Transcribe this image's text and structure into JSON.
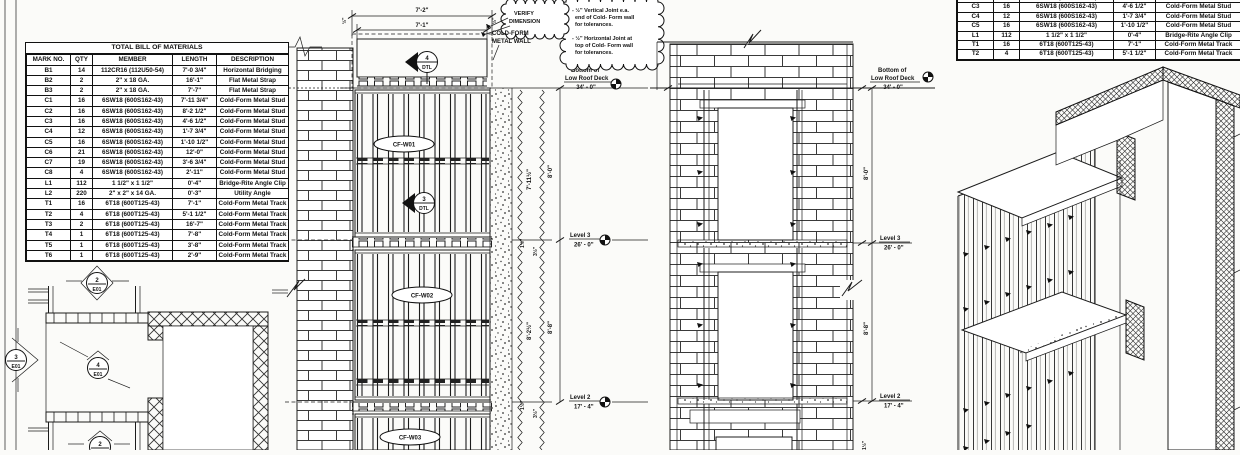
{
  "bom": {
    "title": "TOTAL BILL OF MATERIALS",
    "headers": [
      "MARK NO.",
      "QTY",
      "MEMBER",
      "LENGTH",
      "DESCRIPTION"
    ],
    "rows": [
      [
        "B1",
        "14",
        "112CR16 (112U50-54)",
        "7'-0 3/4\"",
        "Horizontal Bridging"
      ],
      [
        "B2",
        "2",
        "2\" x 18 GA.",
        "16'-1\"",
        "Flat Metal Strap"
      ],
      [
        "B3",
        "2",
        "2\" x 18 GA.",
        "7'-7\"",
        "Flat Metal Strap"
      ],
      [
        "C1",
        "16",
        "6SW18 (600S162-43)",
        "7'-11 3/4\"",
        "Cold-Form Metal Stud"
      ],
      [
        "C2",
        "16",
        "6SW18 (600S162-43)",
        "8'-2 1/2\"",
        "Cold-Form Metal Stud"
      ],
      [
        "C3",
        "16",
        "6SW18 (600S162-43)",
        "4'-6 1/2\"",
        "Cold-Form Metal Stud"
      ],
      [
        "C4",
        "12",
        "6SW18 (600S162-43)",
        "1'-7 3/4\"",
        "Cold-Form Metal Stud"
      ],
      [
        "C5",
        "16",
        "6SW18 (600S162-43)",
        "1'-10 1/2\"",
        "Cold-Form Metal Stud"
      ],
      [
        "C6",
        "21",
        "6SW18 (600S162-43)",
        "12'-0\"",
        "Cold-Form Metal Stud"
      ],
      [
        "C7",
        "19",
        "6SW18 (600S162-43)",
        "3'-6 3/4\"",
        "Cold-Form Metal Stud"
      ],
      [
        "C8",
        "4",
        "6SW18 (600S162-43)",
        "2'-11\"",
        "Cold-Form Metal Stud"
      ],
      [
        "L1",
        "112",
        "1 1/2\" x 1 1/2\"",
        "0'-4\"",
        "Bridge-Rite Angle Clip"
      ],
      [
        "L2",
        "220",
        "2\" x 2\" x 14 GA.",
        "0'-3\"",
        "Utility Angle"
      ],
      [
        "T1",
        "16",
        "6T18 (600T125-43)",
        "7'-1\"",
        "Cold-Form Metal Track"
      ],
      [
        "T2",
        "4",
        "6T18 (600T125-43)",
        "5'-1 1/2\"",
        "Cold-Form Metal Track"
      ],
      [
        "T3",
        "2",
        "6T18 (600T125-43)",
        "16'-7\"",
        "Cold-Form Metal Track"
      ],
      [
        "T4",
        "1",
        "6T18 (600T125-43)",
        "7'-8\"",
        "Cold-Form Metal Track"
      ],
      [
        "T5",
        "1",
        "6T18 (600T125-43)",
        "3'-8\"",
        "Cold-Form Metal Track"
      ],
      [
        "T6",
        "1",
        "6T18 (600T125-43)",
        "2'-9\"",
        "Cold-Form Metal Track"
      ]
    ]
  },
  "bom_right": {
    "rows": [
      [
        "C2",
        "16",
        "6SW18 (600S162-43)",
        "8'-2 1/2\"",
        "Cold-Form Metal Stud"
      ],
      [
        "C3",
        "16",
        "6SW18 (600S162-43)",
        "4'-6 1/2\"",
        "Cold-Form Metal Stud"
      ],
      [
        "C4",
        "12",
        "6SW18 (600S162-43)",
        "1'-7 3/4\"",
        "Cold-Form Metal Stud"
      ],
      [
        "C5",
        "16",
        "6SW18 (600S162-43)",
        "1'-10 1/2\"",
        "Cold-Form Metal Stud"
      ],
      [
        "L1",
        "112",
        "1 1/2\" x 1 1/2\"",
        "0'-4\"",
        "Bridge-Rite Angle Clip"
      ],
      [
        "T1",
        "16",
        "6T18 (600T125-43)",
        "7'-1\"",
        "Cold-Form Metal Track"
      ],
      [
        "T2",
        "4",
        "6T18 (600T125-43)",
        "5'-1 1/2\"",
        "Cold-Form Metal Track"
      ]
    ]
  },
  "cloud": {
    "verify_1": "VERIFY",
    "verify_2": "DIMENSION",
    "note1": [
      "- ½\" Vertical Joint e.a.",
      "end of Cold- Form wall",
      "for tolerances."
    ],
    "note2": [
      "- ½\" Horizontal Joint at",
      "top of Cold- Form wall",
      "for tolerances."
    ]
  },
  "central": {
    "dim_outer": "7'-2\"",
    "dim_inner": "7'-1\"",
    "joint_left": "½\"",
    "joint_right": "½\"",
    "wall_label_1": "COLD-FORM",
    "wall_label_2": "METAL WALL",
    "panel1": "CF-W01",
    "panel2": "CF-W02",
    "panel3": "CF-W03",
    "detail_top_num": "4",
    "detail_top_sheet": "DTL",
    "detail_mid_num": "3",
    "detail_mid_sheet": "DTL",
    "dim_s1a": "7'-11½\"",
    "dim_s1b": "8'-0\"",
    "dim_s2a": "8'-2½\"",
    "dim_s2b": "8'-8\"",
    "dim_t1": "1½\"",
    "dim_t2": "3½\"",
    "dim_t3": "1½\"",
    "dim_t4": "3½\""
  },
  "levels": {
    "roof_l1": "Bottom of",
    "roof_l2": "Low Roof Deck",
    "roof_elev": "34' - 0\"",
    "l3_name": "Level 3",
    "l3_elev": "26' - 0\"",
    "l2_name": "Level 2",
    "l2_elev": "17' - 4\""
  },
  "elev2": {
    "dim_a": "8'-0\"",
    "dim_b": "8'-8\"",
    "dim_c": "1½\""
  },
  "plan": {
    "callout_top_num": "2",
    "callout_top_sheet": "E01",
    "callout_left_num": "3",
    "callout_left_sheet": "E01",
    "callout_mid_num": "4",
    "callout_mid_sheet": "E01",
    "callout_bot_num": "2",
    "callout_bot_sheet": "E01"
  }
}
